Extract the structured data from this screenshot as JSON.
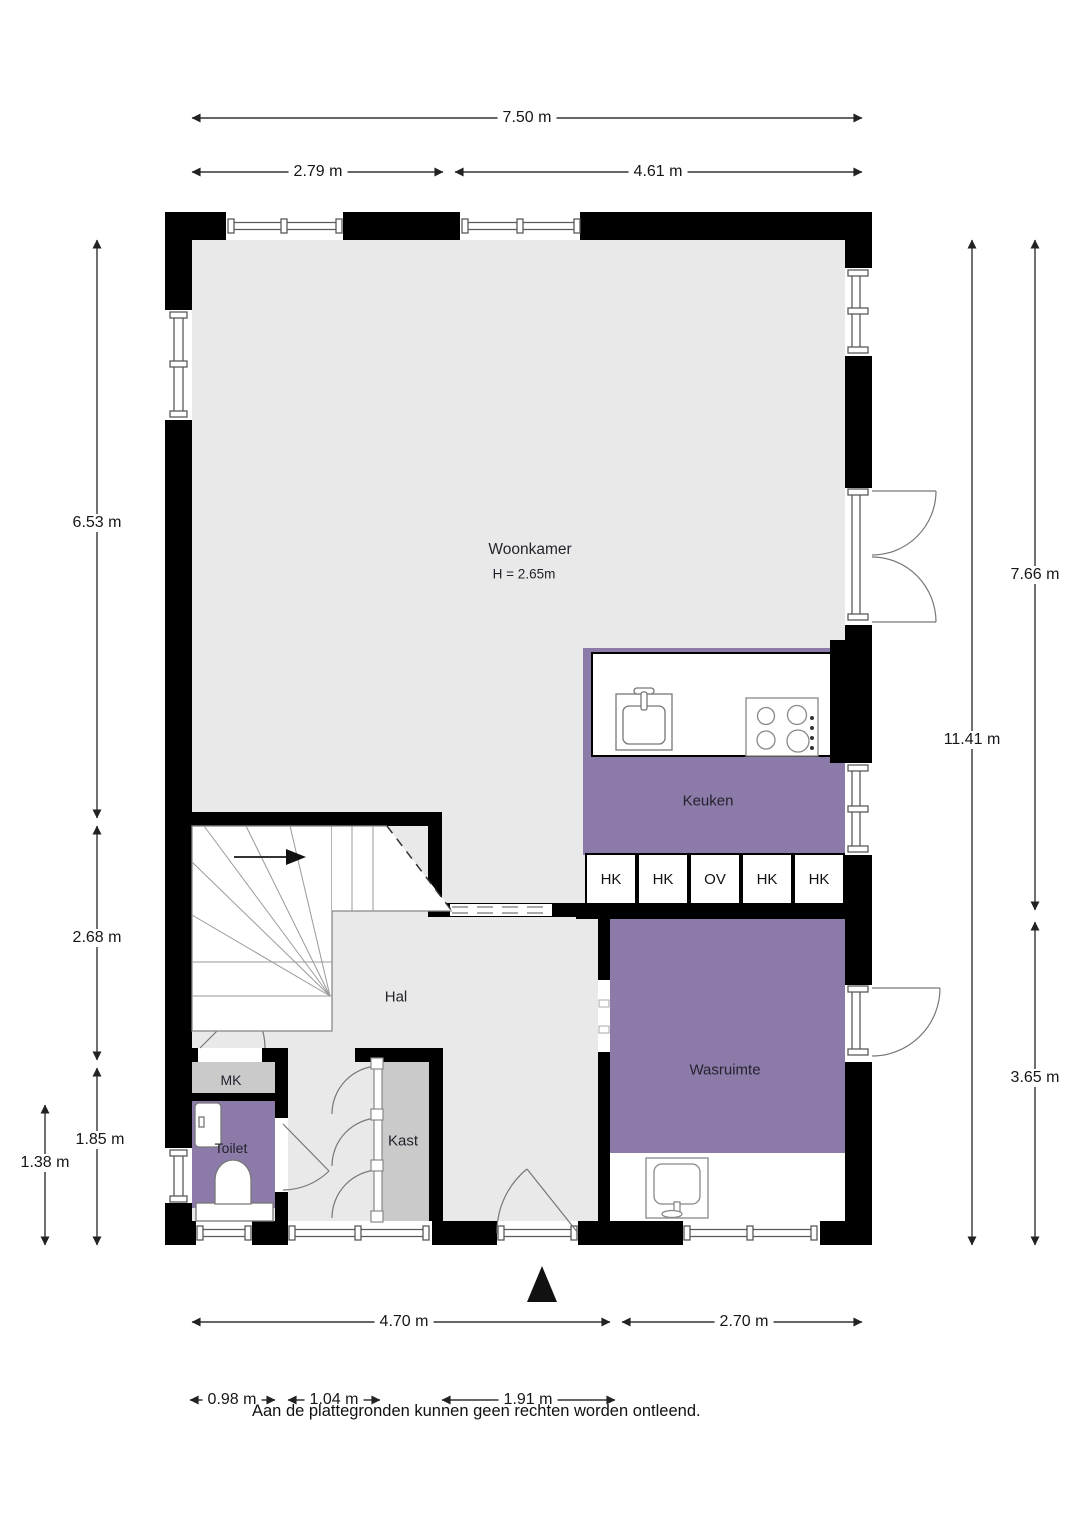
{
  "rooms": {
    "woonkamer": {
      "label": "Woonkamer",
      "ceiling": "H = 2.65m"
    },
    "keuken": {
      "label": "Keuken"
    },
    "hal": {
      "label": "Hal"
    },
    "mk": {
      "label": "MK"
    },
    "toilet": {
      "label": "Toilet"
    },
    "kast": {
      "label": "Kast"
    },
    "wasruimte": {
      "label": "Wasruimte"
    }
  },
  "cabinets": [
    "HK",
    "HK",
    "OV",
    "HK",
    "HK"
  ],
  "dims": {
    "top_total": "7.50 m",
    "top_left": "2.79 m",
    "top_right": "4.61 m",
    "left_upper": "6.53 m",
    "left_mid": "2.68 m",
    "left_lower": "1.85 m",
    "left_inner": "1.38 m",
    "right_upper": "7.66 m",
    "right_total": "11.41 m",
    "right_lower": "3.65 m",
    "bottom_left": "4.70 m",
    "bottom_right": "2.70 m",
    "bottom_sub1": "0.98 m",
    "bottom_sub2": "1.04 m",
    "bottom_sub3": "1.91 m"
  },
  "footer": {
    "disclaimer": "Aan de plattegronden kunnen geen rechten worden ontleend."
  },
  "colors": {
    "room_purple": "#8C7AA8",
    "floor_gray": "#E9E9E9",
    "closet_gray": "#CACACA",
    "wall_black": "#000000"
  }
}
